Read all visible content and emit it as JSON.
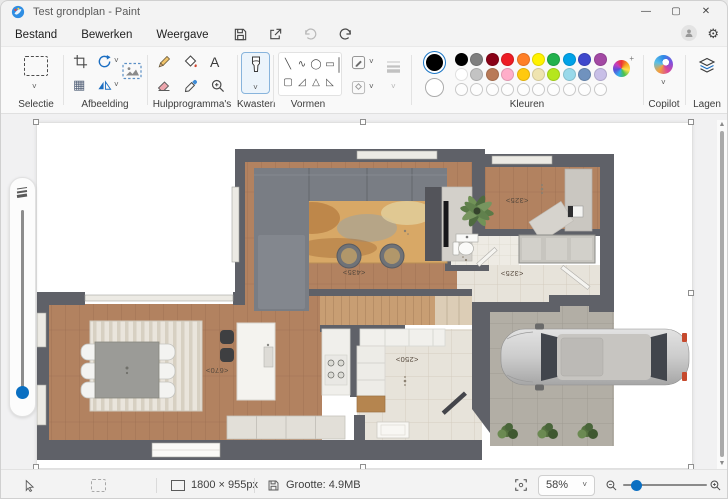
{
  "window": {
    "title": "Test grondplan - Paint",
    "minimize": "—",
    "maximize": "▢",
    "close": "✕"
  },
  "menu": {
    "items": [
      "Bestand",
      "Bewerken",
      "Weergave"
    ]
  },
  "ribbon": {
    "selection_label": "Selectie",
    "image_label": "Afbeelding",
    "tools_label": "Hulpprogramma's",
    "text_tool_glyph": "A",
    "brushes_label": "Kwasten",
    "shapes_label": "Vormen",
    "shapes_glyphs": [
      "╲",
      "∿",
      "◯",
      "▭",
      "▢",
      "◿",
      "△",
      "◺",
      "◇",
      "○",
      "□",
      "⇨",
      "⇧",
      "✦",
      "★",
      "♥"
    ],
    "colors_label": "Kleuren",
    "color1": "#000000",
    "color2": "#ffffff",
    "palette_row1": [
      "#000000",
      "#7f7f7f",
      "#880015",
      "#ed1c24",
      "#ff7f27",
      "#fff200",
      "#22b14c",
      "#00a2e8",
      "#3f48cc",
      "#a349a4"
    ],
    "palette_row2": [
      "#ffffff",
      "#c3c3c3",
      "#b97a57",
      "#ffaec9",
      "#ffc90e",
      "#efe4b0",
      "#b5e61d",
      "#99d9ea",
      "#7092be",
      "#c8bfe7"
    ],
    "palette_row3": [
      "",
      "",
      "",
      "",
      "",
      "",
      "",
      "",
      "",
      ""
    ],
    "copilot_label": "Copilot",
    "layers_label": "Lagen"
  },
  "canvas": {
    "labels": {
      "living": "<435>",
      "study": "<325>",
      "hall": "<325>",
      "dining": "<670>",
      "entry": "<250>"
    }
  },
  "statusbar": {
    "dimensions": "1800 × 955px",
    "file_size": "Grootte: 4.9MB",
    "zoom": "58%"
  }
}
